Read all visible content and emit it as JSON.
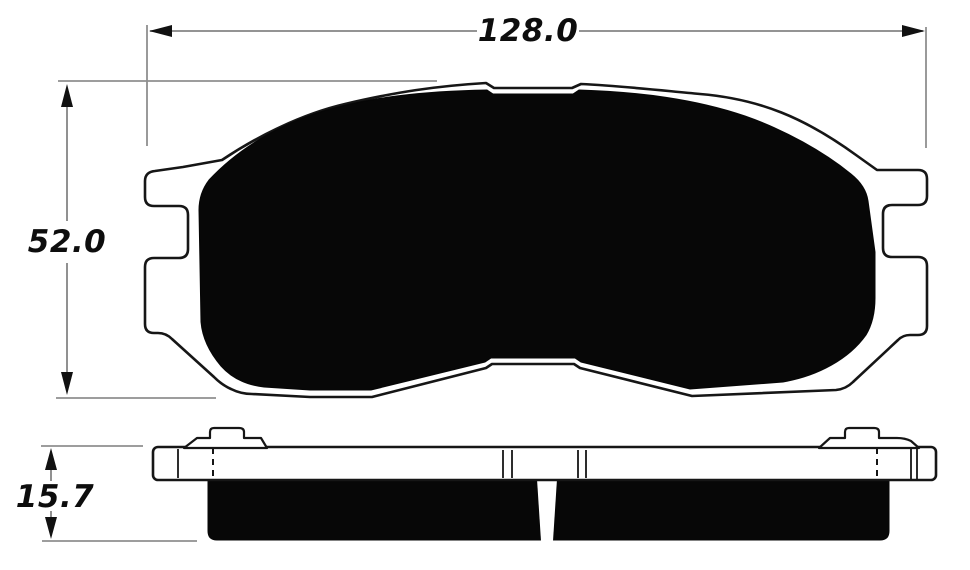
{
  "drawing": {
    "dimensions": {
      "width": "128.0",
      "height": "52.0",
      "thickness": "15.7"
    },
    "colors": {
      "background": "#ffffff",
      "outline": "#161616",
      "friction_fill": "#070707",
      "dimension_line": "#858585",
      "dimension_text": "#0d0d0d"
    }
  }
}
